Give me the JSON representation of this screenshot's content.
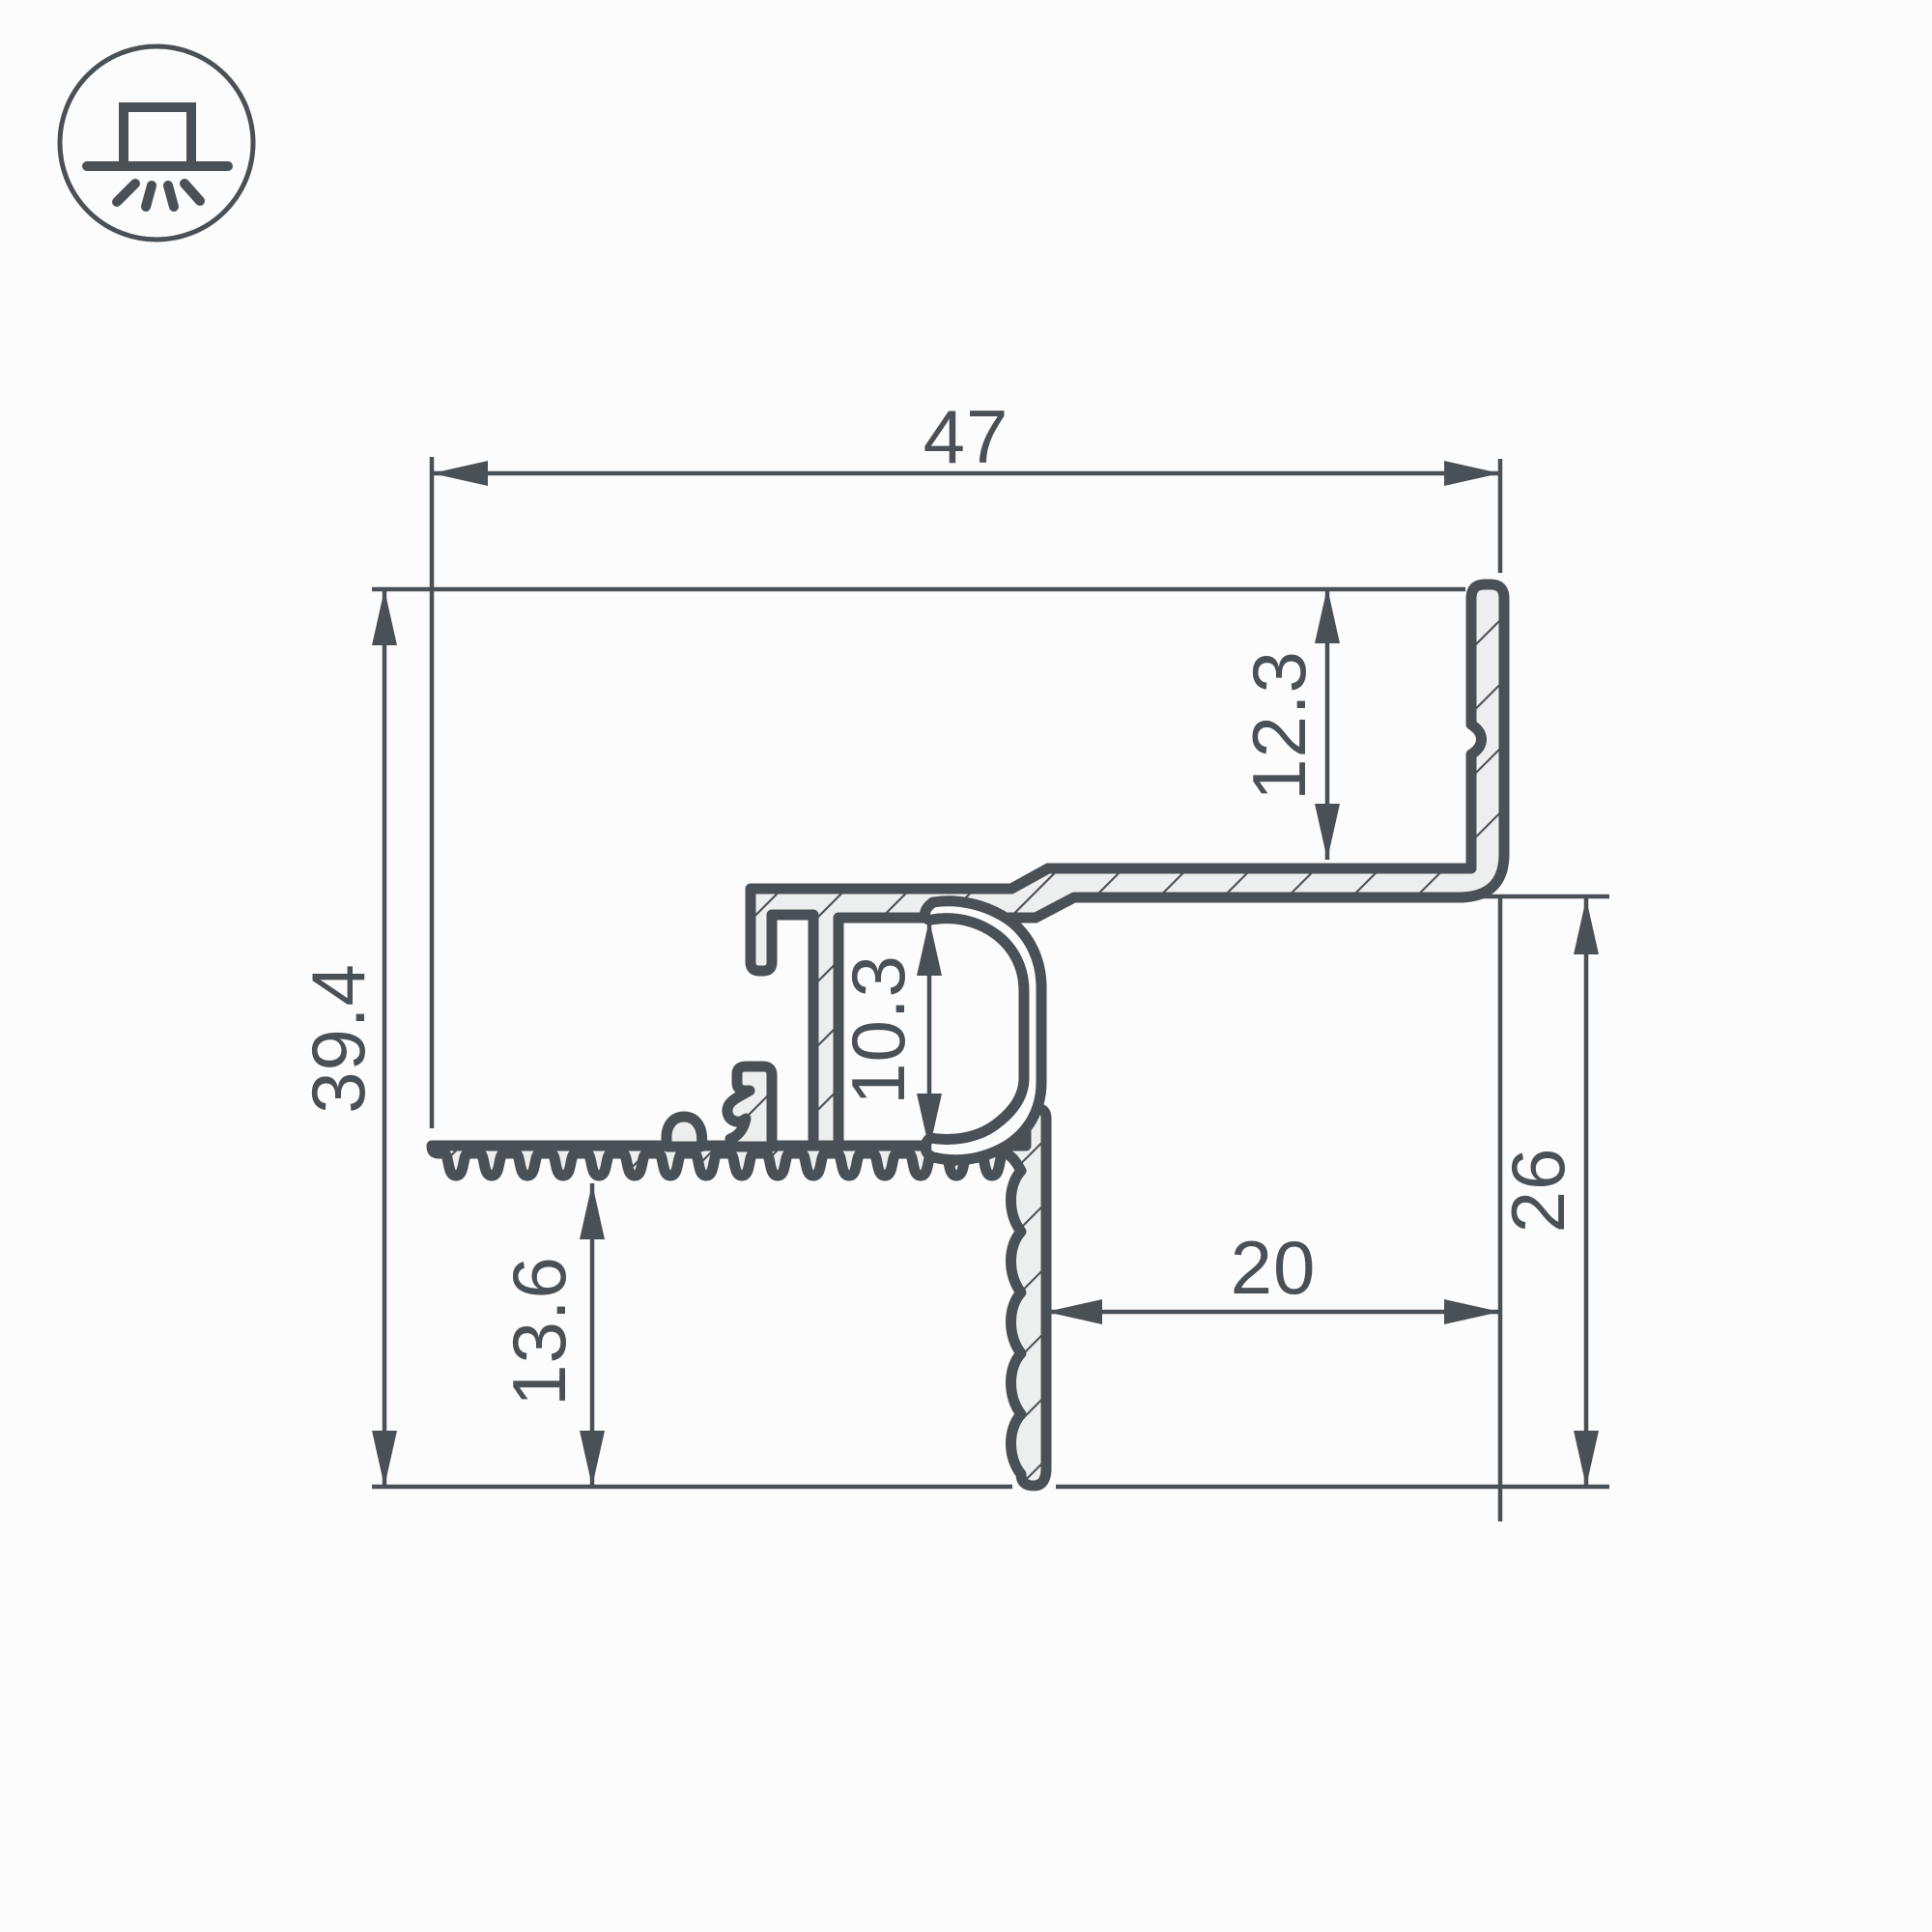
{
  "drawing": {
    "type": "profile-cross-section-dimension-drawing",
    "icon": {
      "name": "recessed-light-icon"
    },
    "colors": {
      "ink": "#4a5156",
      "metal_fill": "#edeeee",
      "cover_fill": "#fbfcfc",
      "background": "#fcfcfd"
    },
    "dimensions": {
      "total_width": "47",
      "total_height": "39.4",
      "flange_height": "12.3",
      "channel_inner_height": "10.3",
      "right_height": "26",
      "bottom_offset": "20",
      "lower_left_height": "13.6"
    }
  }
}
